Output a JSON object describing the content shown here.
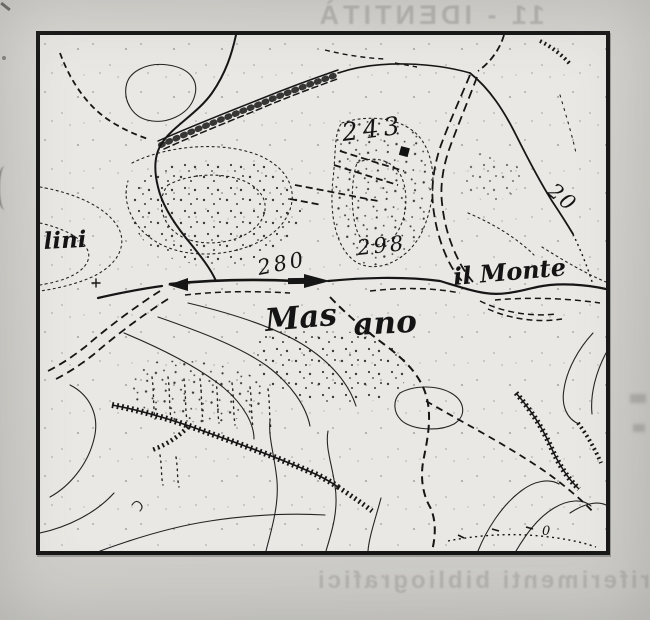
{
  "page": {
    "description": "Scanned book page with topographic map excerpt and bleed-through text from reverse side",
    "bleed_through_top": "11 - IDENTITÀ",
    "bleed_through_bottom": "riferimenti bibliografici"
  },
  "map": {
    "kind": "topographic-map-scan",
    "labels": {
      "height_243": "243",
      "height_298": "298",
      "height_280": "280",
      "height_20": "20",
      "height_0": "0",
      "masano_a": "Mas",
      "masano_b": "ano",
      "il_monte": "il Monte",
      "lini": "lini"
    },
    "colors": {
      "ink": "#161616",
      "map_paper": "#e9e8e4",
      "page_background": "#d2d1cd",
      "bleed_text": "#9b9a97"
    }
  }
}
